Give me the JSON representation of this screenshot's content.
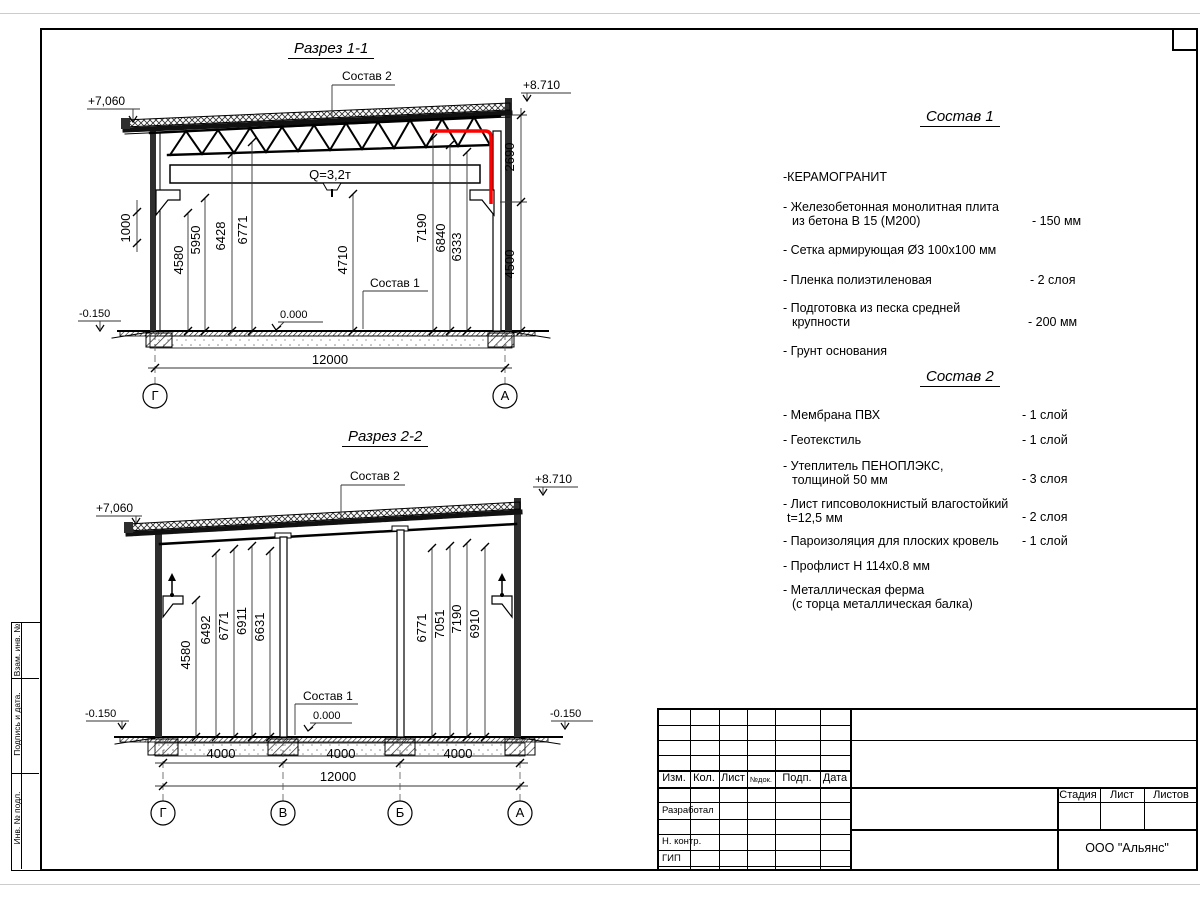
{
  "s1": {
    "title": "Разрез 1-1",
    "sostav2": "Состав 2",
    "sostav1": "Состав 1",
    "elev_left": "+7,060",
    "elev_right": "+8.710",
    "crane": "Q=3,2т",
    "dim_1000": "1000",
    "heights": [
      "4580",
      "5950",
      "6428",
      "6771",
      "4710",
      "7190",
      "6840",
      "6333"
    ],
    "dim_2690": "2690",
    "dim_4500": "4500",
    "zero": "0.000",
    "minus": "-0.150",
    "span": "12000",
    "axis_left": "Г",
    "axis_right": "А"
  },
  "s2": {
    "title": "Разрез 2-2",
    "sostav2": "Состав 2",
    "sostav1": "Состав 1",
    "elev_left": "+7,060",
    "elev_right": "+8.710",
    "heights_left": [
      "4580",
      "6492",
      "6771",
      "6911",
      "6631"
    ],
    "heights_right": [
      "6771",
      "7051",
      "7190",
      "6910"
    ],
    "zero": "0.000",
    "minus_left": "-0.150",
    "minus_right": "-0.150",
    "bays": [
      "4000",
      "4000",
      "4000"
    ],
    "span": "12000",
    "axes": [
      "Г",
      "В",
      "Б",
      "А"
    ]
  },
  "c1": {
    "title": "Состав 1",
    "items": [
      {
        "l1": "-КЕРАМОГРАНИТ"
      },
      {
        "l1": "- Железобетонная  монолитная плита",
        "l2": "из бетона В 15 (М200)",
        "val": "- 150 мм"
      },
      {
        "l1": "- Сетка армирующая Ø3 100х100 мм"
      },
      {
        "l1": "- Пленка полиэтиленовая",
        "val": "-  2 слоя"
      },
      {
        "l1": "- Подготовка из песка средней",
        "l2": "крупности",
        "val": "- 200 мм"
      },
      {
        "l1": "- Грунт основания"
      }
    ]
  },
  "c2": {
    "title": "Состав 2",
    "items": [
      {
        "l1": "- Мембрана ПВХ",
        "val": "- 1 слой"
      },
      {
        "l1": "- Геотекстиль",
        "val": "- 1 слой"
      },
      {
        "l1": "- Утеплитель ПЕНОПЛЭКС,",
        "l2": "толщиной 50 мм",
        "val": "- 3 слоя"
      },
      {
        "l1": "- Лист гипсоволокнистый влагостойкий",
        "l2": "t=12,5 мм",
        "val": "- 2 слоя"
      },
      {
        "l1": "- Пароизоляция для плоских кровель",
        "val": "- 1 слой"
      },
      {
        "l1": "- Профлист Н 114х0.8 мм"
      },
      {
        "l1": "- Металлическая ферма",
        "l2": "(с торца металлическая балка)"
      }
    ]
  },
  "tb": {
    "cols": [
      "Изм.",
      "Кол.",
      "Лист",
      "№док.",
      "Подп.",
      "Дата"
    ],
    "developed": "Разработал",
    "ncontr": "Н. контр.",
    "gip": "ГИП",
    "stage": "Стадия",
    "sheet": "Лист",
    "sheets": "Листов",
    "company": "ООО \"Альянс\""
  },
  "strip": {
    "r1": "Взам. инв. №",
    "r2": "Подпись  и  дата.",
    "r3": "Инв. № подл."
  },
  "colors": {
    "accent_red": "#ff0000"
  }
}
